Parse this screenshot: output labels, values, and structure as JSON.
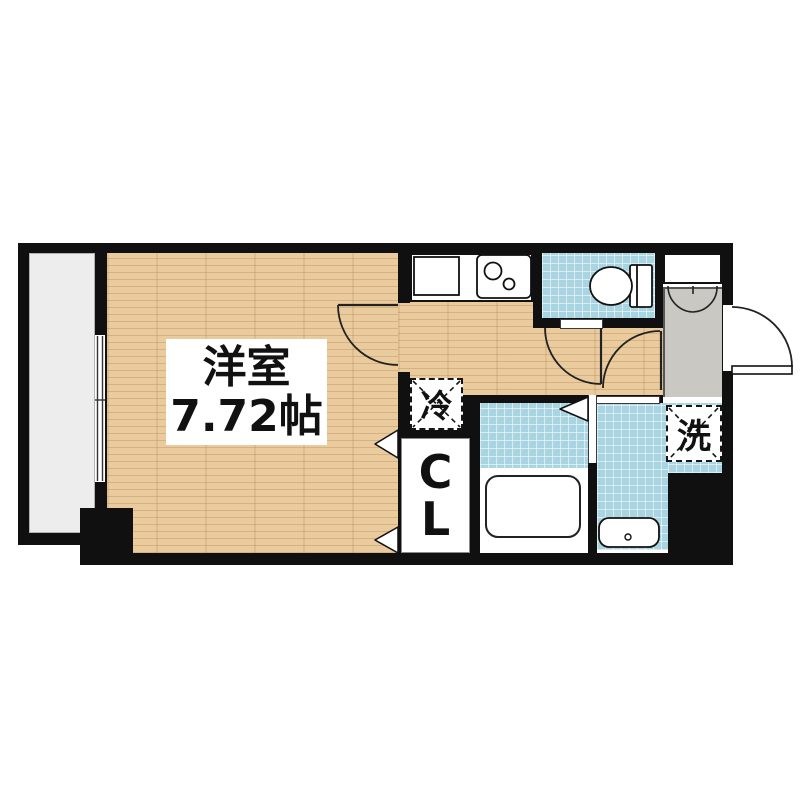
{
  "plan": {
    "western_room": {
      "label": "洋室",
      "area": "7.72帖"
    },
    "closet": {
      "letters": [
        "C",
        "L"
      ]
    },
    "refrigerator_label": "冷",
    "washer_label": "洗"
  },
  "colors": {
    "wall": "#101010",
    "wood_floor": "#e9cb9e",
    "tile_floor": "#a9d4e2",
    "entrance_floor": "#c9c8c3",
    "balcony_floor": "#ededed",
    "line": "#1a1a1a"
  }
}
